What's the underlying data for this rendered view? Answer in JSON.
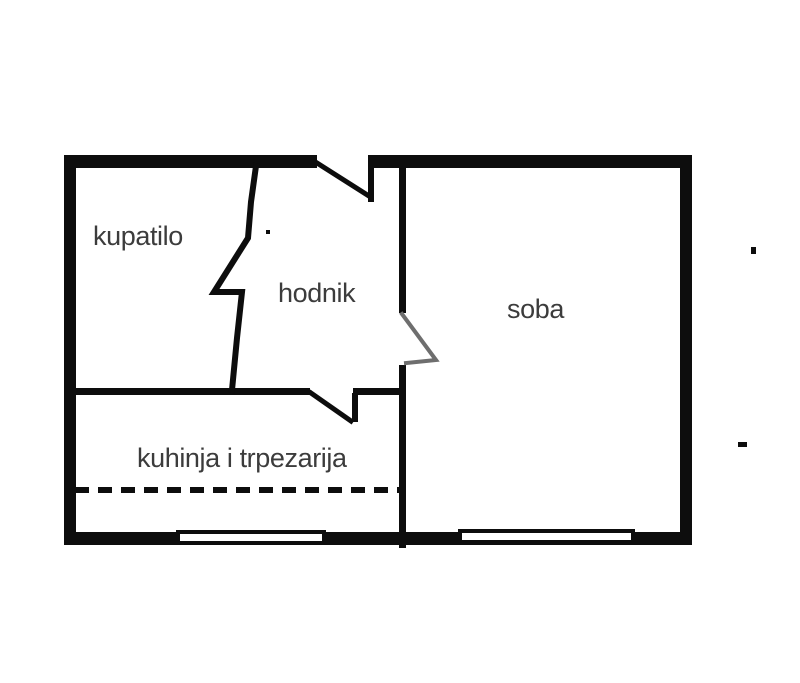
{
  "diagram": {
    "kind": "apartment floor plan",
    "background_color": "#ffffff",
    "wall_color": "#0d0d0d",
    "label_color": "#3c3c3c",
    "door_swing_color": "#6e6e6e"
  },
  "rooms": [
    {
      "id": "kupatilo",
      "label": "kupatilo"
    },
    {
      "id": "hodnik",
      "label": "hodnik"
    },
    {
      "id": "soba",
      "label": "soba"
    },
    {
      "id": "kuhinja-trpezarija",
      "label": "kuhinja i trpezarija"
    }
  ],
  "features": {
    "doors": 4,
    "windows": 2,
    "dashed_partition": true
  }
}
